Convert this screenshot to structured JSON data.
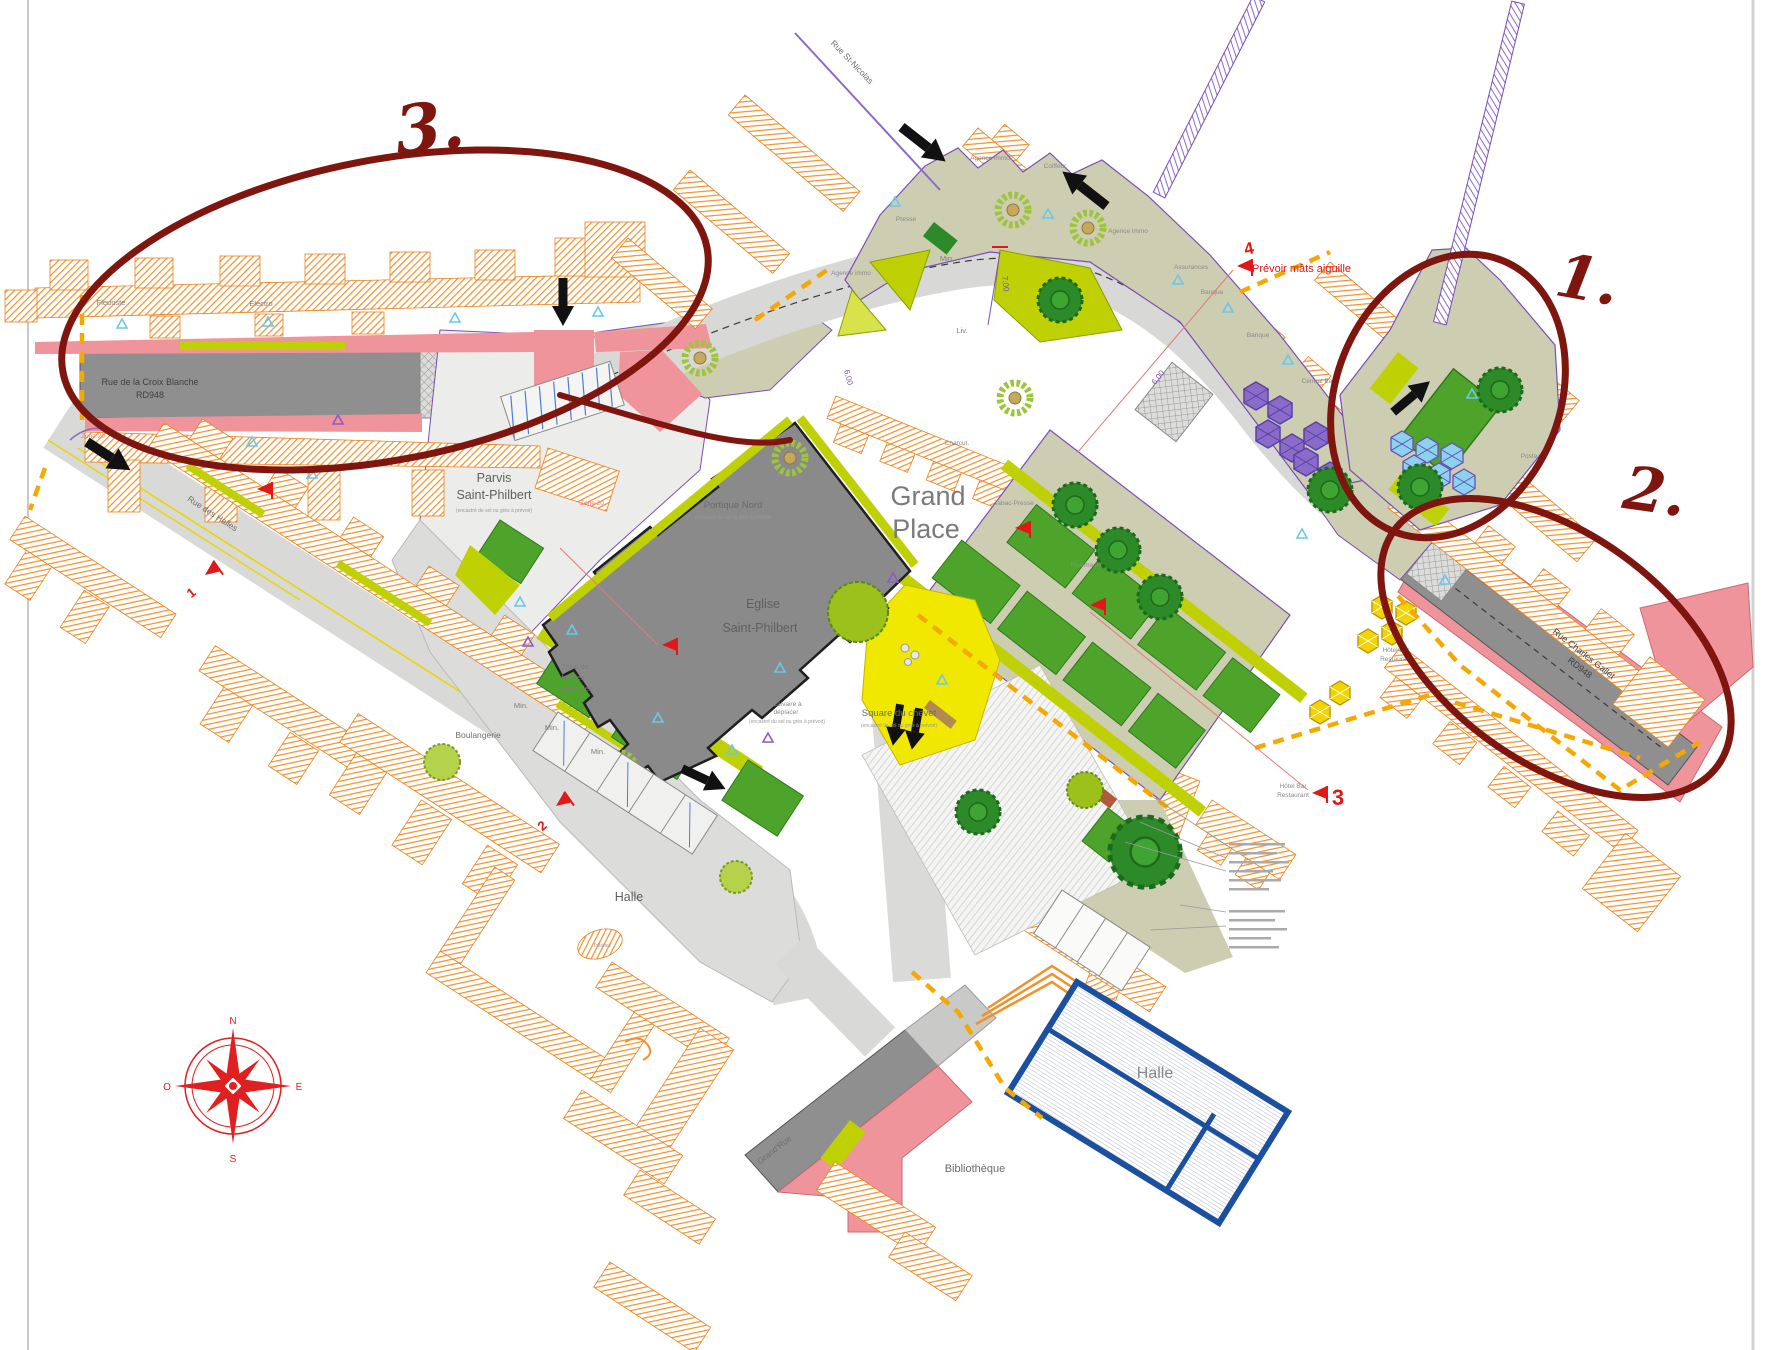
{
  "annotations": {
    "mark1": "1.",
    "mark2": "2.",
    "mark3": "3.",
    "ink_color": "#7e150e"
  },
  "compass": {
    "north": "N",
    "east": "E",
    "south": "S",
    "west": "O"
  },
  "roads": {
    "croix_blanche": "Rue de la Croix Blanche",
    "rd948": "RD948",
    "st_nicolas": "Rue St-Nicolas",
    "des_halles": "Rue des Halles",
    "charles_gallet": "Rue Charles Gallet",
    "grand_rue": "Grand'Rue"
  },
  "places": {
    "grand_place_1": "Grand",
    "grand_place_2": "Place",
    "parvis_1": "Parvis",
    "parvis_2": "Saint-Philbert",
    "eglise_1": "Eglise",
    "eglise_2": "Saint-Philbert",
    "portique_nord": "Portique Nord",
    "square_chevet": "Square du chevet",
    "halle": "Halle",
    "bibliotheque": "Bibliothèque",
    "recessed_note": "(encastré de sol ou grès à prévoir)"
  },
  "shops": {
    "fleuriste": "Fleuriste",
    "electro": "Electro",
    "agence_immo": "Agence immo",
    "coiffeur": "Coiffeur",
    "presse": "Presse",
    "min": "Min.",
    "liv": "Liv.",
    "assurances": "Assurances",
    "banque": "Banque",
    "central_bar": "Central Bar",
    "poste": "Poste",
    "tabac_presse": "Tabac-Presse",
    "pharmacie": "Pharmacie",
    "charcut": "Charcut.",
    "hotel_line1": "Hôtel Bar",
    "hotel_line2": "Restaurant",
    "boulangerie": "Boulangerie",
    "toilettes": "Toilettes"
  },
  "notes": {
    "mats": "Prévoir mâts aiguille",
    "calvaire_1": "Calvaire à",
    "calvaire_2": "déplacer",
    "calvaire_note": "(encastré du sol ou grès à prévoir)",
    "fouilles_1": "Zone de",
    "fouilles_2": "fouilles",
    "fouilles_3": "possibles",
    "zone20": "Zone 20"
  },
  "dimensions": {
    "d700": "7,00",
    "d600": "6,00"
  },
  "flags": {
    "f1": "1",
    "f2": "2",
    "f3": "3",
    "f4": "4"
  },
  "colors": {
    "hatch_orange": "#f0912c",
    "road_gray": "#8f8f8f",
    "pink": "#f0949b",
    "khaki": "#cdcdb2",
    "lawn": "#4ea32a",
    "chartreuse": "#bfd104",
    "yellow": "#f0e800",
    "halle_blue": "#1b4fa0",
    "annotation_red": "#7e150e"
  }
}
